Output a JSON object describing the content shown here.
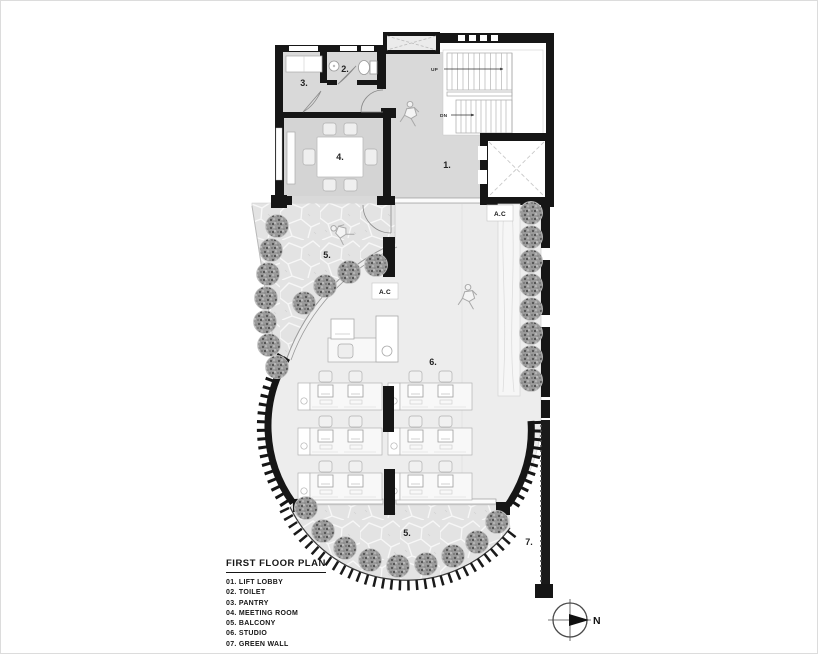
{
  "legend": {
    "title": "FIRST FLOOR PLAN",
    "items": [
      "01. LIFT LOBBY",
      "02. TOILET",
      "03. PANTRY",
      "04. MEETING ROOM",
      "05. BALCONY",
      "06. STUDIO",
      "07. GREEN WALL"
    ]
  },
  "rooms": {
    "lift_lobby": "1.",
    "toilet": "2.",
    "pantry": "3.",
    "meeting_room": "4.",
    "balcony": "5.",
    "studio": "6.",
    "green_wall": "7."
  },
  "annotations": {
    "stair_up": "UP",
    "stair_down": "DN",
    "ac_unit": "A.C",
    "north": "N"
  },
  "colors": {
    "wall": "#161616",
    "room_fill": "#d9d9d9",
    "studio_fill": "#ededed",
    "stone_fill": "#e3e3e3",
    "tree_fill": "#9b9b9b",
    "line": "#999999"
  }
}
